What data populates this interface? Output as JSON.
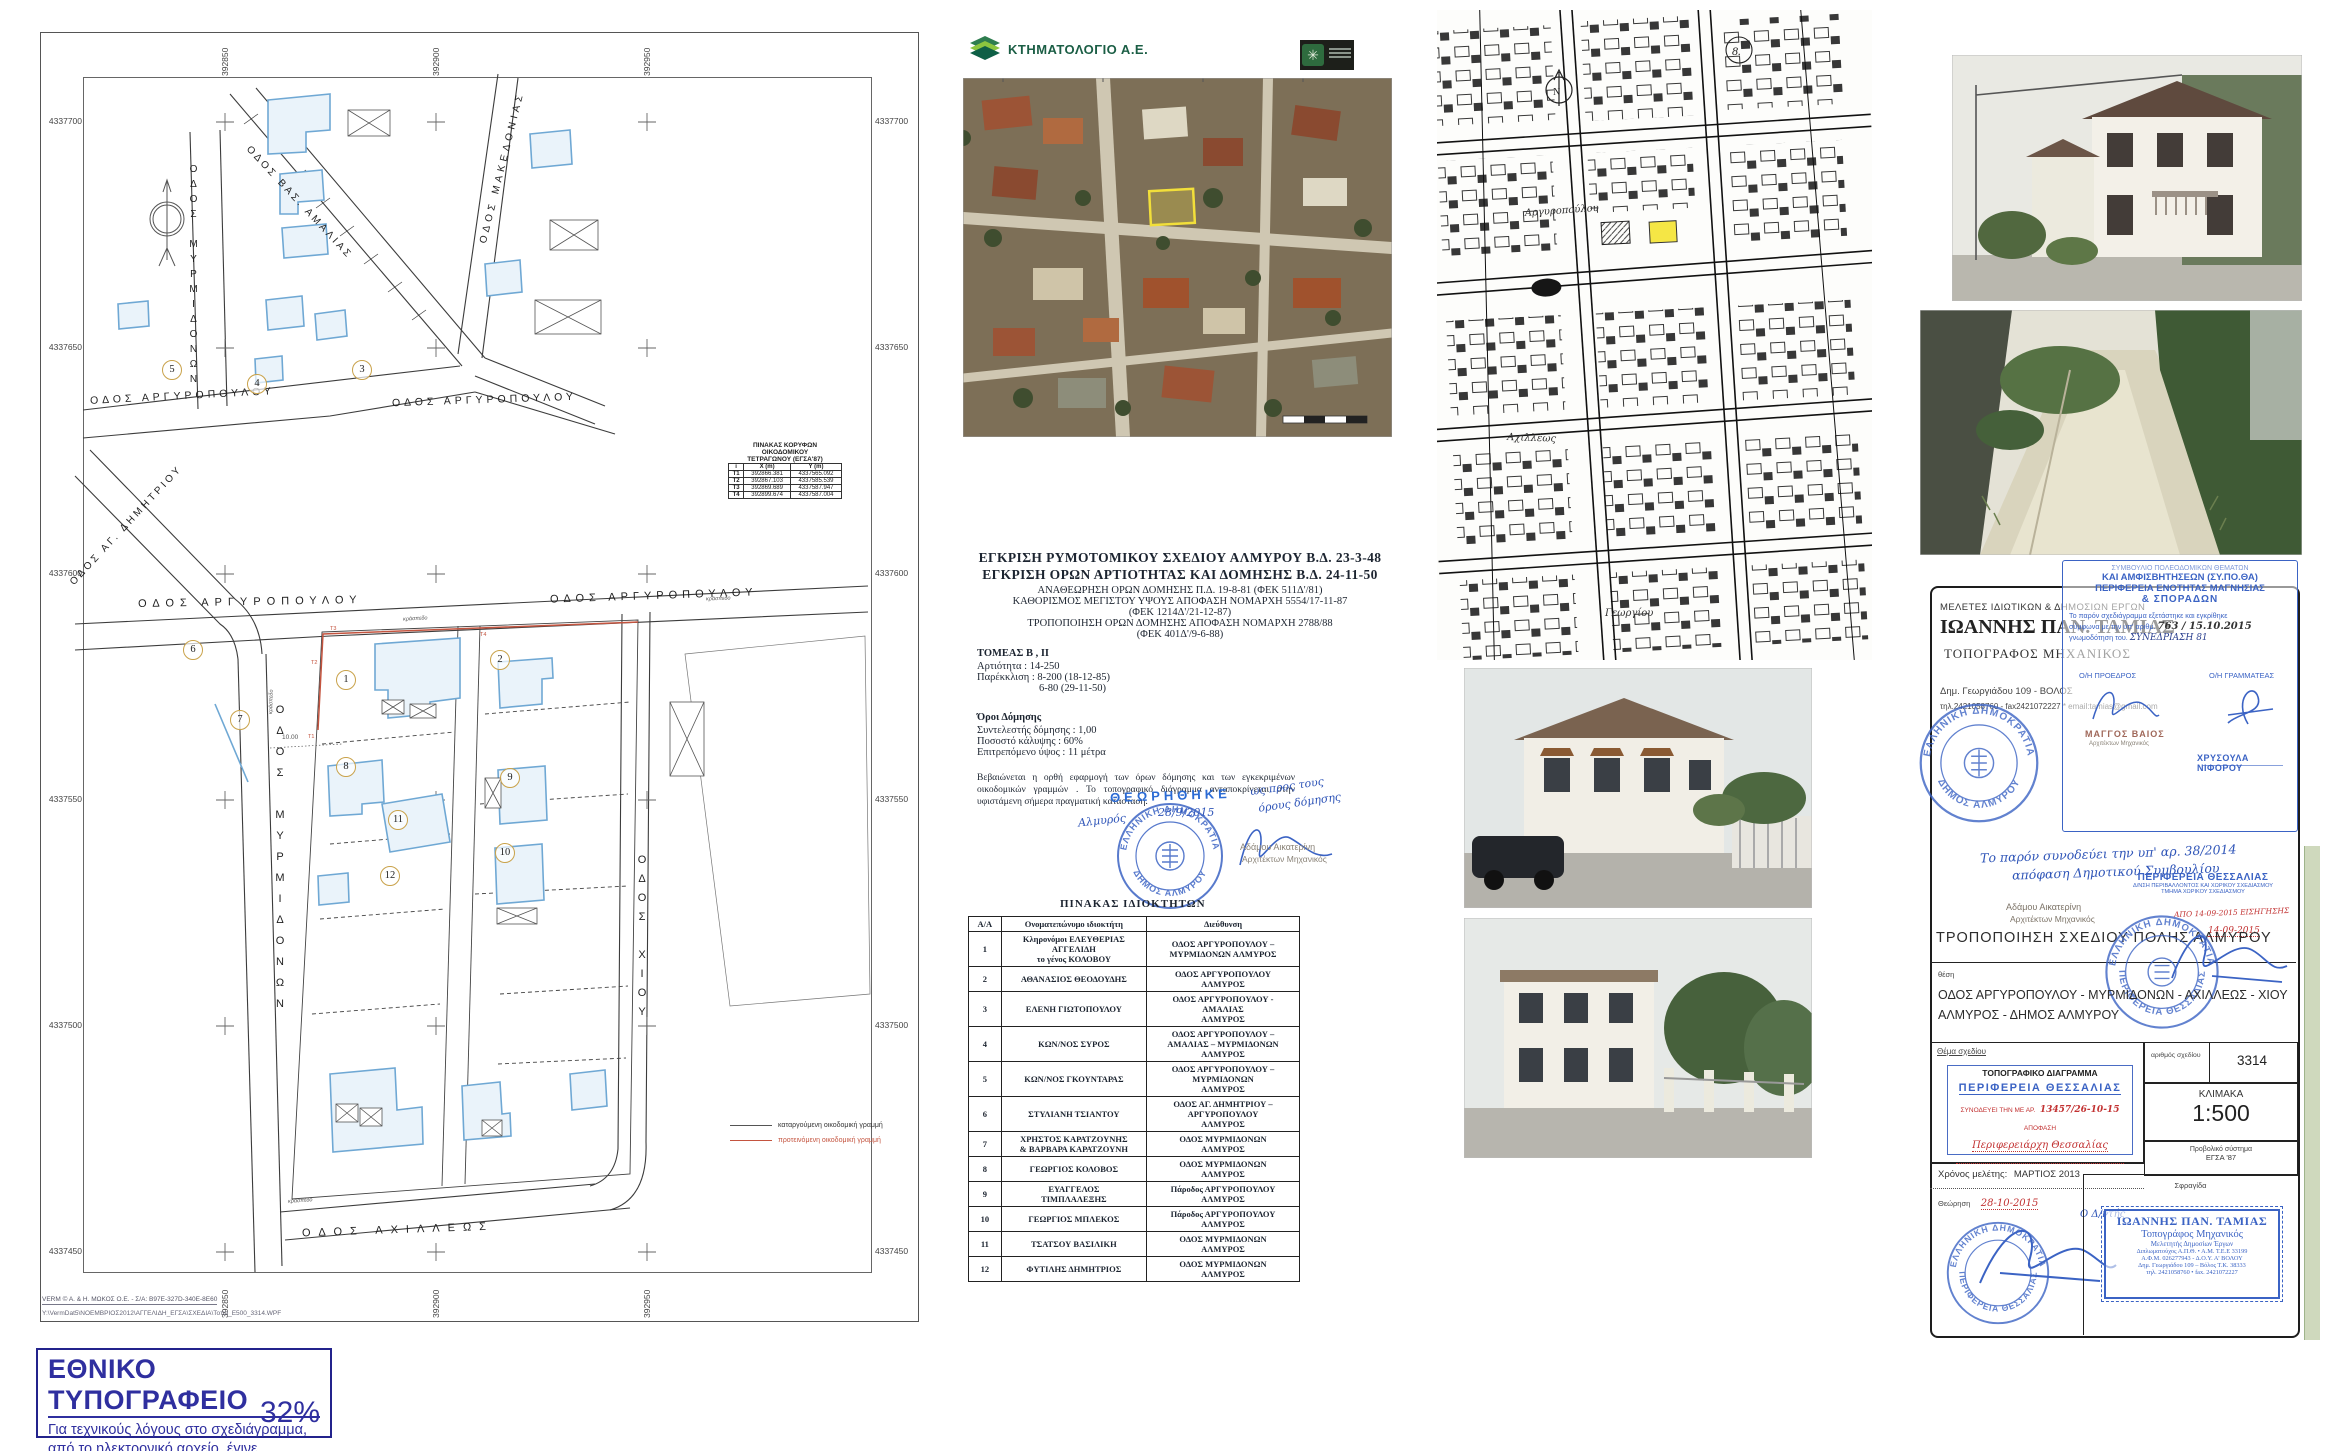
{
  "sheet": {
    "coords_y": [
      "4337700",
      "4337650",
      "4337600",
      "4337550",
      "4337500",
      "4337450"
    ],
    "coords_x": [
      "392850",
      "392900",
      "392950"
    ],
    "streets": {
      "myrmidonon_upper": "ΟΔΟΣ ΜΥΡΜΙΔΟΝΩΝ",
      "myrmidonon_lower": "ΟΔΟΣ ΜΥΡΜΙΔΟΝΩΝ",
      "makedonias": "ΟΔΟΣ ΜΑΚΕΔΟΝΙΑΣ",
      "amalias": "ΟΔΟΣ ΒΑΣ. ΑΜΑΛΙΑΣ",
      "argyropoulou_nw": "ΟΔΟΣ ΑΡΓΥΡΟΠΟΥΛΟΥ",
      "argyropoulou_ne": "ΟΔΟΣ ΑΡΓΥΡΟΠΟΥΛΟΥ",
      "argyropoulou_sw": "ΟΔΟΣ ΑΡΓΥΡΟΠΟΥΛΟΥ",
      "argyropoulou_se": "ΟΔΟΣ ΑΡΓΥΡΟΠΟΥΛΟΥ",
      "ag_dimitriou": "ΟΔΟΣ ΑΓ. ΔΗΜΗΤΡΙΟΥ",
      "chiou": "ΟΔΟΣ ΧΙΟΥ",
      "achilleos": "ΟΔΟΣ ΑΧΙΛΛΕΩΣ"
    },
    "plots": [
      "1",
      "2",
      "3",
      "4",
      "5",
      "6",
      "7",
      "8",
      "9",
      "10",
      "11",
      "12"
    ],
    "red_marks": [
      "T1",
      "T2",
      "T3",
      "T4"
    ],
    "dim_label": "10.00",
    "curb_label": "κράσπεδο",
    "vertex_table": {
      "title_l1": "ΠΙΝΑΚΑΣ ΚΟΡΥΦΩΝ",
      "title_l2": "ΟΙΚΟΔΟΜΙΚΟΥ",
      "title_l3": "ΤΕΤΡΑΓΩΝΟΥ  (ΕΓΣΑ'87)",
      "h1": "i",
      "h2": "X (m)",
      "h3": "Y (m)",
      "rows": [
        {
          "i": "T1",
          "x": "392866.381",
          "y": "4337565.092"
        },
        {
          "i": "T2",
          "x": "392867.103",
          "y": "4337585.539"
        },
        {
          "i": "T3",
          "x": "392869.689",
          "y": "4337587.947"
        },
        {
          "i": "T4",
          "x": "392899.674",
          "y": "4337587.004"
        }
      ]
    },
    "legend": {
      "item1": "καταργούμενη οικοδομική γραμμή",
      "item2": "προτεινόμενη  οικοδομική γραμμή"
    },
    "footer1": "VERM © A. & H.  ΜΩΚΟΣ  Ο.Ε. - Σ/Α: B97E-327D-340E-8E60",
    "footer2": "Y:\\VermDat5\\ΝΟΕΜΒΡΙΟΣ2012\\ΑΓΓΕΛΙΔΗ_ΕΓΣΑ\\ΣΧΕΔΙΑ\\Τοπο_Ε500_3314.WPF"
  },
  "print_note": {
    "title": "ΕΘΝΙΚΟ ΤΥΠΟΓΡΑΦΕΙΟ",
    "line1": "Για  τεχνικούς  λόγους  στο  σχεδιάγραμμα,",
    "line2": "από το ηλεκτρονικό αρχείο, έγινε",
    "line3": "σμίκρυνση κατά ποσοστό",
    "percent": "32%"
  },
  "ortho": {
    "brand": "ΚΤΗΜΑΤΟΛΟΓΙΟ Α.Ε."
  },
  "approvals": {
    "l1": "ΕΓΚΡΙΣΗ  ΡΥΜΟΤΟΜΙΚΟΥ ΣΧΕΔΙΟΥ  ΑΛΜΥΡΟΥ  Β.Δ. 23-3-48",
    "l2": "ΕΓΚΡΙΣΗ ΟΡΩΝ ΑΡΤΙΟΤΗΤΑΣ ΚΑΙ ΔΟΜΗΣΗΣ  Β.Δ. 24-11-50",
    "l3": "ΑΝΑΘΕΩΡΗΣΗ ΟΡΩΝ ΔΟΜΗΣΗΣ Π.Δ. 19-8-81 (ΦΕΚ 511Δ'/81)",
    "l4": "ΚΑΘΟΡΙΣΜΟΣ ΜΕΓΙΣΤΟΥ ΥΨΟΥΣ ΑΠΟΦΑΣΗ ΝΟΜΑΡΧΗ 5554/17-11-87",
    "l5": "(ΦΕΚ 1214Δ'/21-12-87)",
    "l6": "ΤΡΟΠΟΠΟΙΗΣΗ ΟΡΩΝ ΔΟΜΗΣΗΣ ΑΠΟΦΑΣΗ ΝΟΜΑΡΧΗ 2788/88",
    "l7": "(ΦΕΚ 401Δ'/9-6-88)"
  },
  "sector": {
    "title": "ΤΟΜΕΑΣ Β , ΙΙ",
    "l1": "Αρτιότητα :   14-250",
    "l2": "Παρέκκλιση : 8-200 (18-12-85)",
    "l3": "6-80   (29-11-50)"
  },
  "terms": {
    "title": "Όροι Δόμησης",
    "l1": "Συντελεστής δόμησης : 1,00",
    "l2": "Ποσοστό κάλυψης : 60%",
    "l3": "Επιτρεπόμενο ύψος : 11 μέτρα"
  },
  "certification": "Βεβαιώνεται  η  ορθή  εφαρμογή  των  όρων  δόμησης  και  των  εγκεκριμένων οικοδομικών  γραμμών .  Το  τοπογραφικό  διάγραμμα  ανταποκρίνεται  στην υφιστάμενη σήμερα πραγματική κατάσταση.",
  "review_stamp": {
    "theorithike": "ΘΕΩΡΗΘΗΚΕ",
    "hand1": "ως προς τους",
    "hand2": "όρους δόμησης",
    "place": "Αλμυρός",
    "date": "28/9/2015",
    "ring_top": "ΕΛΛΗΝΙΚΗ ΔΗΜΟΚΡΑΤΙΑ",
    "ring_bottom": "ΔΗΜΟΣ ΑΛΜΥΡΟΥ",
    "signer": "Αδάμου Αικατερίνη",
    "signer_title": "Αρχιτέκτων Μηχανικός"
  },
  "owners": {
    "title": "ΠΙΝΑΚΑΣ  ΙΔΙΟΚΤΗΤΩΝ",
    "h_num": "Α/Α",
    "h_name": "Ονοματεπώνυμο  ιδιοκτήτη",
    "h_addr": "Διεύθυνση",
    "rows": [
      {
        "n": "1",
        "name": "Κληρονόμοι  ΕΛΕΥΘΕΡΙΑΣ\nΑΓΓΕΛΙΔΗ\nτο γένος  ΚΟΛΟΒΟΥ",
        "addr": "ΟΔΟΣ ΑΡΓΥΡΟΠΟΥΛΟΥ –\nΜΥΡΜΙΔΟΝΩΝ  ΑΛΜΥΡΟΣ"
      },
      {
        "n": "2",
        "name": "ΑΘΑΝΑΣΙΟΣ ΘΕΟΔΟΥΔΗΣ",
        "addr": "ΟΔΟΣ ΑΡΓΥΡΟΠΟΥΛΟΥ\nΑΛΜΥΡΟΣ"
      },
      {
        "n": "3",
        "name": "ΕΛΕΝΗ ΓΙΩΤΟΠΟΥΛΟΥ",
        "addr": "ΟΔΟΣ  ΑΡΓΥΡΟΠΟΥΛΟΥ  -\nΑΜΑΛΙΑΣ\nΑΛΜΥΡΟΣ"
      },
      {
        "n": "4",
        "name": "ΚΩΝ/ΝΟΣ ΣΥΡΟΣ",
        "addr": "ΟΔΟΣ ΑΡΓΥΡΟΠΟΥΛΟΥ –\nΑΜΑΛΙΑΣ – ΜΥΡΜΙΔΟΝΩΝ\nΑΛΜΥΡΟΣ"
      },
      {
        "n": "5",
        "name": "ΚΩΝ/ΝΟΣ ΓΚΟΥΝΤΑΡΑΣ",
        "addr": "ΟΔΟΣ ΑΡΓΥΡΟΠΟΥΛΟΥ –\nΜΥΡΜΙΔΟΝΩΝ\nΑΛΜΥΡΟΣ"
      },
      {
        "n": "6",
        "name": "ΣΤΥΛΙΑΝΗ ΤΣΙΑΝΤΟΥ",
        "addr": "ΟΔΟΣ  ΑΓ. ΔΗΜΗΤΡΙΟΥ –\nΑΡΓΥΡΟΠΟΥΛΟΥ\nΑΛΜΥΡΟΣ"
      },
      {
        "n": "7",
        "name": "ΧΡΗΣΤΟΣ ΚΑΡΑΤΖΟΥΝΗΣ\n& ΒΑΡΒΑΡΑ ΚΑΡΑΤΖΟΥΝΗ",
        "addr": "ΟΔΟΣ  ΜΥΡΜΙΔΟΝΩΝ\nΑΛΜΥΡΟΣ"
      },
      {
        "n": "8",
        "name": "ΓΕΩΡΓΙΟΣ ΚΟΛΟΒΟΣ",
        "addr": "ΟΔΟΣ  ΜΥΡΜΙΔΟΝΩΝ\nΑΛΜΥΡΟΣ"
      },
      {
        "n": "9",
        "name": "ΕΥΑΓΓΕΛΟΣ\nΤΙΜΠΛΑΛΕΞΗΣ",
        "addr": "Πάροδος ΑΡΓΥΡΟΠΟΥΛΟΥ\nΑΛΜΥΡΟΣ"
      },
      {
        "n": "10",
        "name": "ΓΕΩΡΓΙΟΣ ΜΠΛΕΚΟΣ",
        "addr": "Πάροδος ΑΡΓΥΡΟΠΟΥΛΟΥ\nΑΛΜΥΡΟΣ"
      },
      {
        "n": "11",
        "name": "ΤΣΑΤΣΟΥ  ΒΑΣΙΛΙΚΗ",
        "addr": "ΟΔΟΣ  ΜΥΡΜΙΔΟΝΩΝ\nΑΛΜΥΡΟΣ"
      },
      {
        "n": "12",
        "name": "ΦΥΤΙΛΗΣ ΔΗΜΗΤΡΙΟΣ",
        "addr": "ΟΔΟΣ  ΜΥΡΜΙΔΟΝΩΝ\nΑΛΜΥΡΟΣ"
      }
    ]
  },
  "bwmap": {
    "label1": "Αργυροπούλου",
    "label2": "Αχιλλέως",
    "label3": "Γεωργίου",
    "north": "N",
    "page_no": "8."
  },
  "titleblock": {
    "firm": "ΜΕΛΕΤΕΣ ΙΔΙΩΤΙΚΩΝ & ΔΗΜΟΣΙΩΝ ΕΡΓΩΝ",
    "name": "ΙΩΑΝΝΗΣ ΠΑΝ. ΤΑΜΙΑΣ",
    "role": "ΤΟΠΟΓΡΑΦΟΣ ΜΗΧΑΝΙΚΟΣ",
    "address": "Δημ. Γεωργιάδου 109 - ΒΟΛΟΣ",
    "contact": "τηλ.2421058760 - fax2421072227 * email:tamias@gmail.com",
    "sypotha": {
      "l1": "ΣΥΜΒΟΥΛΙΟ ΠΟΛΕΟΔΟΜΙΚΩΝ ΘΕΜΑΤΩΝ",
      "l2": "ΚΑΙ ΑΜΦΙΣΒΗΤΗΣΕΩΝ (ΣΥ.ΠΟ.ΘΑ)",
      "l3": "ΠΕΡΙΦΕΡΕΙΑ ΕΝΟΤΗΤΑΣ ΜΑΓΝΗΣΙΑΣ",
      "l4": "& ΣΠΟΡΑΔΩΝ",
      "body1": "Το παρόν σχεδιάγραμμα εξετάστηκε και εγκρίθηκε",
      "body2": "σύμφωνα με την υπ' αριθμ.",
      "num": "763 / 15.10.2015",
      "body3": "γνωμοδότηση του.",
      "session": "ΣΥΝΕΔΡΙΑΣΗ 81",
      "president_label": "Ο/Η ΠΡΟΕΔΡΟΣ",
      "secretary_label": "Ο/Η ΓΡΑΜΜΑΤΕΑΣ",
      "president": "ΜΑΓΓΟΣ ΒΑΙΟΣ",
      "president_sub": "Αρχιτέκτων Μηχανικός",
      "secretary": "ΧΡΥΣΟΥΛΑ ΝΙΦΟΡΟΥ"
    },
    "hand_note1": "Το παρόν συνοδεύει την υπ' αρ. 38/2014",
    "hand_note2": "απόφαση Δημοτικού Συμβουλίου",
    "thessaly_stamp": {
      "l1": "ΠΕΡΙΦΕΡΕΙΑ  ΘΕΣΣΑΛΙΑΣ",
      "l2": "Δ/ΝΣΗ ΠΕΡΙΒΑΛΛΟΝΤΟΣ ΚΑΙ ΧΩΡΙΚΟΥ ΣΧΕΔΙΑΣΜΟΥ",
      "l3": "ΤΜΗΜΑ ΧΩΡΙΚΟΥ ΣΧΕΔΙΑΣΜΟΥ"
    },
    "red_date1": "ΑΠΟ 14-09-2015  ΕΙΣΗΓΗΣΗΣ",
    "red_date2": "14-09-2015",
    "adamou": "Αδάμου Αικατερίνη",
    "adamou_title": "Αρχιτέκτων Μηχανικός",
    "project_title": "ΤΡΟΠΟΠΟΙΗΣΗ ΣΧΕΔΙΟΥ ΠΟΛΗΣ ΑΛΜΥΡΟΥ",
    "ring2_top": "ΕΛΛΗΝΙΚΗ ΔΗΜΟΚΡΑΤΙΑ",
    "ring2_bottom": "ΠΕΡΙΦΕΡΕΙΑ ΘΕΣΣΑΛΙΑΣ",
    "location_label": "θέση",
    "location1": "ΟΔΟΣ ΑΡΓΥΡΟΠΟΥΛΟΥ - ΜΥΡΜΙΔΟΝΩΝ - ΑΧΙΛΛΕΩΣ - ΧΙΟΥ",
    "location2": "ΑΛΜΥΡΟΣ - ΔΗΜΟΣ  ΑΛΜΥΡΟΥ",
    "drawing_subject_label": "Θέμα σχεδίου",
    "topo_stamp": {
      "l1": "ΤΟΠΟΓΡΑΦΙΚΟ ΔΙΑΓΡΑΜΜΑ",
      "l2": "ΠΕΡΙΦΕΡΕΙΑ  ΘΕΣΣΑΛΙΑΣ",
      "l3": "ΣΥΝΟΔΕΥΕΙ ΤΗΝ ΜΕ ΑΡ.",
      "num": "13457/26-10-15",
      "l4": "ΑΠΟΦΑΣΗ",
      "hand": "Περιφερειάρχη  Θεσσαλίας"
    },
    "number_label": "αριθμός σχεδίου",
    "number": "3314",
    "scale_label": "ΚΛΙΜΑΚΑ",
    "scale": "1:500",
    "projection_label": "Προβολικό σύστημα",
    "projection": "ΕΓΣΑ '87",
    "study_label": "Χρόνος μελέτης:",
    "study_value": "ΜΑΡΤΙΟΣ 2013",
    "review_label": "Θεώρηση",
    "review_date": "28-10-2015",
    "director": "Ο Δ/ντής",
    "seal_label": "Σφραγίδα",
    "seal": {
      "l1": "ΙΩΑΝΝΗΣ  ΠΑΝ.  ΤΑΜΙΑΣ",
      "l2": "Τοπογράφος Μηχανικός",
      "l3": "Μελετητής Δημοσίων Έργων",
      "l4": "Διπλωματούχος Α.Π.Θ.  • Α.Μ. Τ.Ε.Ε 33199",
      "l5": "Α.Φ.Μ. 026277943 - Δ.Ο.Υ. Α' ΒΟΛΟΥ",
      "l6": "Δημ. Γεωργιάδου 109 – Βόλος Τ.Κ. 38333",
      "l7": "τηλ. 2421058760 • fax. 2421072227"
    }
  }
}
